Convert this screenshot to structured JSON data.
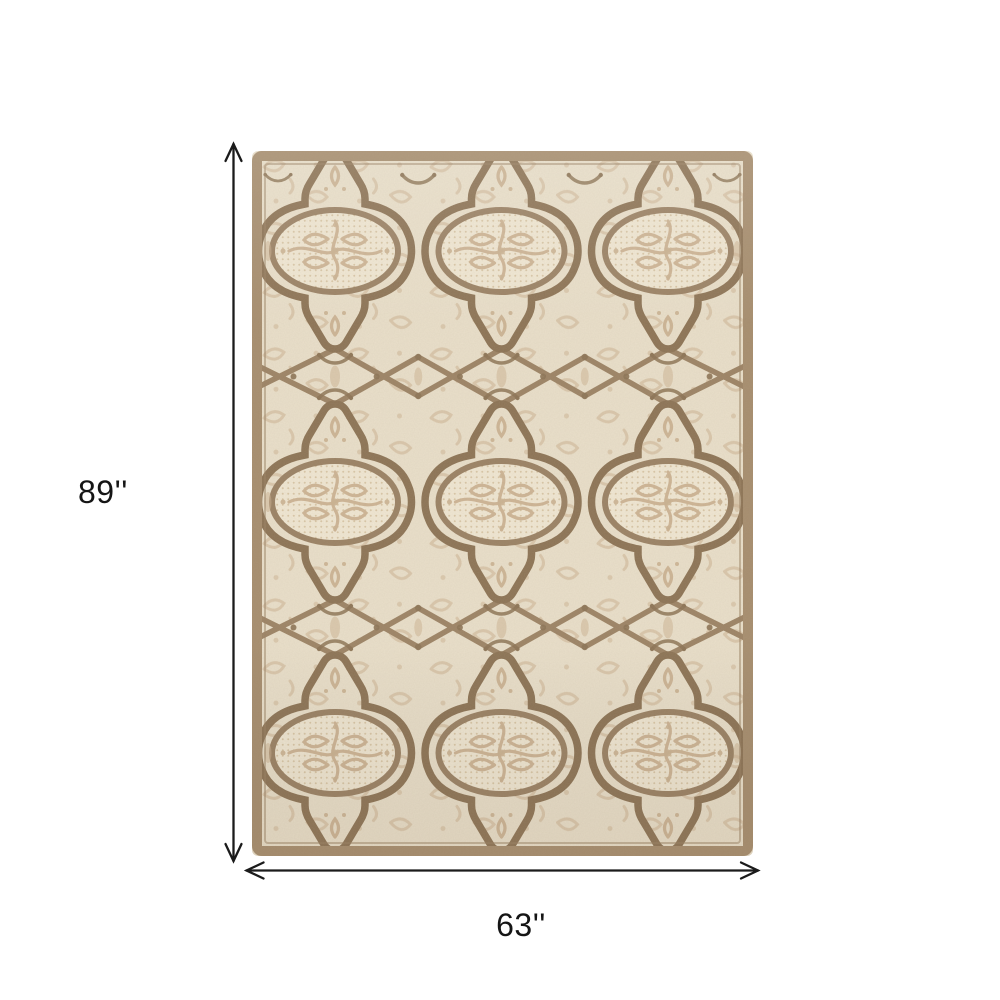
{
  "background": "#ffffff",
  "annotations": {
    "height_label": "89''",
    "width_label": "63''",
    "arrow_color": "#1b1b1b",
    "label_color": "#151515"
  },
  "rug": {
    "description": "Cream and taupe ornate quatrefoil trellis area rug, portrait orientation",
    "colors": {
      "field_cream": "#eae0cb",
      "field_light": "#f1e8d4",
      "pattern_brown": "#8c7355",
      "lattice_brown": "#9c8365",
      "ring_taupe": "#9a8164",
      "ornament_tan": "#cbb292",
      "texture_dot": "#d9c7a7",
      "border_tan": "#a68d6e"
    }
  }
}
